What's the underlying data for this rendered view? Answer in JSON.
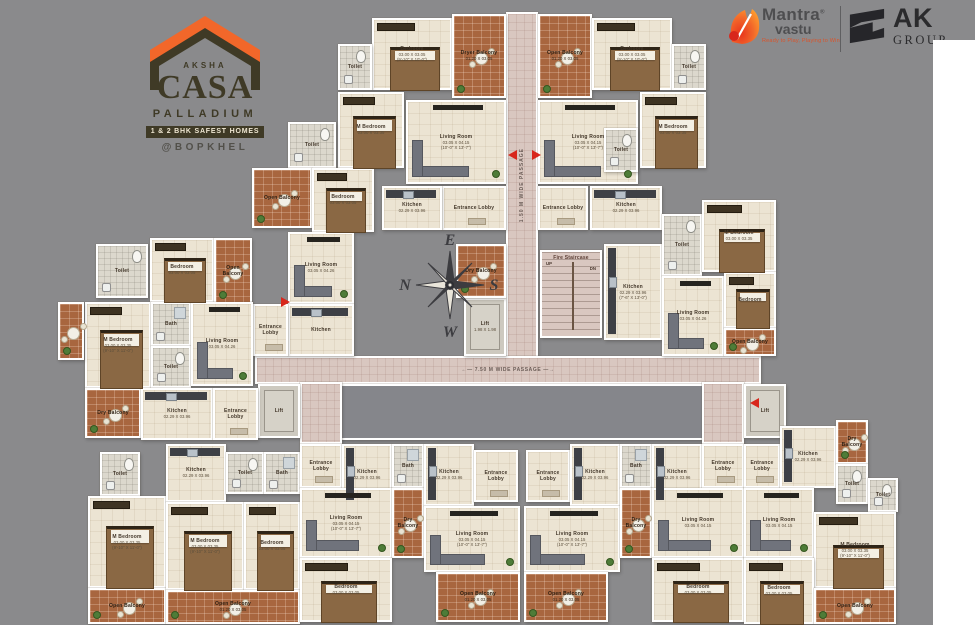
{
  "branding": {
    "aksha": {
      "name": "AKSHA",
      "brand": "CASA",
      "sub": "PALLADIUM",
      "badge": "1 & 2 BHK SAFEST HOMES",
      "location": "@BOPKHEL"
    },
    "mantra": {
      "line1": "Mantra",
      "reg": "®",
      "line2": "vastu",
      "tagline": "Ready to Play, Playing to Win"
    },
    "ak": {
      "line1": "AK",
      "line2": "GROUP"
    }
  },
  "colors": {
    "background": "#8a8a8c",
    "accent_orange": "#f2672a",
    "logo_olive": "#3f3a26",
    "floor_cream": "#ece4d3",
    "balcony_terracotta": "#a8663f",
    "passage_pink": "#d9c7c0",
    "wall_white": "#ffffff",
    "entry_arrow_red": "#d8271c"
  },
  "compass": {
    "top": "E",
    "right": "S",
    "bottom": "W",
    "left": "N"
  },
  "plan": {
    "stair_up": "UP",
    "stair_dn": "DN",
    "rooms": [
      {
        "n": "passage-vertical",
        "t": "passage",
        "x": 506,
        "y": 12,
        "w": 32,
        "h": 346,
        "l": "1.50 M WIDE PASSAGE",
        "rot": 1
      },
      {
        "n": "passage-horizontal",
        "t": "passage",
        "x": 255,
        "y": 356,
        "w": 506,
        "h": 28,
        "l": "←—  7.50 M WIDE PASSAGE  —→"
      },
      {
        "n": "void-center",
        "t": "void",
        "x": 340,
        "y": 384,
        "w": 364,
        "h": 56
      },
      {
        "n": "passage-stub-left",
        "t": "passage",
        "x": 300,
        "y": 382,
        "w": 42,
        "h": 62
      },
      {
        "n": "passage-stub-right",
        "t": "passage",
        "x": 702,
        "y": 382,
        "w": 42,
        "h": 62
      },
      {
        "n": "lift-left",
        "t": "lift",
        "x": 258,
        "y": 384,
        "w": 42,
        "h": 54,
        "l": "Lift"
      },
      {
        "n": "lift-right",
        "t": "lift",
        "x": 744,
        "y": 384,
        "w": 42,
        "h": 54,
        "l": "Lift"
      },
      {
        "n": "lift-central",
        "t": "lift",
        "x": 464,
        "y": 298,
        "w": 42,
        "h": 58,
        "l": "Lift",
        "d1": "1.98 X 1.98"
      },
      {
        "n": "fire-staircase",
        "t": "stair",
        "x": 540,
        "y": 250,
        "w": 62,
        "h": 88,
        "l": "Fire Staircase"
      },
      {
        "n": "bedroom-a",
        "t": "bed",
        "x": 372,
        "y": 18,
        "w": 80,
        "h": 72,
        "l": "Bedroom",
        "d1": "03.00 X 03.05",
        "d2": "(9'-10\" X 10'-0\")"
      },
      {
        "n": "toilet-a",
        "t": "toilet",
        "x": 338,
        "y": 44,
        "w": 34,
        "h": 46,
        "l": "Toilet"
      },
      {
        "n": "dryer-balcony-a",
        "t": "balc",
        "x": 452,
        "y": 14,
        "w": 54,
        "h": 84,
        "l": "Dryer Balcony",
        "d1": "01.20 X 03.05"
      },
      {
        "n": "m-bedroom-a",
        "t": "bed",
        "x": 338,
        "y": 92,
        "w": 66,
        "h": 76,
        "l": "M Bedroom",
        "d1": "03.00 X 03.35"
      },
      {
        "n": "living-a",
        "t": "sofa",
        "x": 406,
        "y": 100,
        "w": 100,
        "h": 84,
        "l": "Living Room",
        "d1": "03.05 X 04.15",
        "d2": "(10'-0\" X 13'-7\")"
      },
      {
        "n": "lobby-a",
        "t": "lobby",
        "x": 442,
        "y": 186,
        "w": 64,
        "h": 44,
        "l": "Entrance Lobby"
      },
      {
        "n": "kitchen-a",
        "t": "kitchen",
        "x": 382,
        "y": 186,
        "w": 60,
        "h": 44,
        "l": "Kitchen",
        "d1": "02.29 X 03.96"
      },
      {
        "n": "dry-balcony-a",
        "t": "balc",
        "x": 456,
        "y": 244,
        "w": 50,
        "h": 54,
        "l": "Dry Balcony"
      },
      {
        "n": "open-balcony-b",
        "t": "balc",
        "x": 538,
        "y": 14,
        "w": 54,
        "h": 84,
        "l": "Open Balcony",
        "d1": "01.20 X 03.05"
      },
      {
        "n": "bedroom-b",
        "t": "bed",
        "x": 592,
        "y": 18,
        "w": 80,
        "h": 72,
        "l": "Bedroom",
        "d1": "03.00 X 03.05",
        "d2": "(9'-10\" X 10'-0\")"
      },
      {
        "n": "toilet-b",
        "t": "toilet",
        "x": 672,
        "y": 44,
        "w": 34,
        "h": 46,
        "l": "Toilet"
      },
      {
        "n": "living-b",
        "t": "sofa",
        "x": 538,
        "y": 100,
        "w": 100,
        "h": 84,
        "l": "Living Room",
        "d1": "03.05 X 04.15",
        "d2": "(10'-0\" X 13'-7\")"
      },
      {
        "n": "m-bedroom-b",
        "t": "bed",
        "x": 640,
        "y": 92,
        "w": 66,
        "h": 76,
        "l": "M Bedroom",
        "d1": "03.00 X 03.35"
      },
      {
        "n": "lobby-b",
        "t": "lobby",
        "x": 538,
        "y": 186,
        "w": 50,
        "h": 44,
        "l": "Entrance Lobby"
      },
      {
        "n": "kitchen-b",
        "t": "kitchen",
        "x": 590,
        "y": 186,
        "w": 72,
        "h": 44,
        "l": "Kitchen",
        "d1": "02.29 X 03.96"
      },
      {
        "n": "toilet-b2",
        "t": "toilet",
        "x": 604,
        "y": 128,
        "w": 34,
        "h": 44,
        "l": "Toilet"
      },
      {
        "n": "toilet-c",
        "t": "toilet",
        "x": 288,
        "y": 122,
        "w": 48,
        "h": 46,
        "l": "Toilet"
      },
      {
        "n": "open-balcony-c",
        "t": "balc",
        "x": 252,
        "y": 168,
        "w": 60,
        "h": 60,
        "l": "Open Balcony"
      },
      {
        "n": "bedroom-c",
        "t": "bed",
        "x": 312,
        "y": 168,
        "w": 62,
        "h": 64,
        "l": "Bedroom",
        "d1": "03.00 X 03.05"
      },
      {
        "n": "living-c",
        "t": "sofa",
        "x": 288,
        "y": 232,
        "w": 66,
        "h": 72,
        "l": "Living Room",
        "d1": "03.05 X 04.26"
      },
      {
        "n": "kitchen-c",
        "t": "kitchen",
        "x": 288,
        "y": 304,
        "w": 66,
        "h": 52,
        "l": "Kitchen"
      },
      {
        "n": "lobby-c",
        "t": "lobby",
        "x": 253,
        "y": 304,
        "w": 35,
        "h": 52,
        "l": "Entrance Lobby"
      },
      {
        "n": "toilet-d",
        "t": "toilet",
        "x": 96,
        "y": 244,
        "w": 52,
        "h": 54,
        "l": "Toilet"
      },
      {
        "n": "bedroom-d",
        "t": "bed",
        "x": 150,
        "y": 238,
        "w": 64,
        "h": 64,
        "l": "Bedroom",
        "d1": "03.00 X 03.05"
      },
      {
        "n": "open-balcony-d",
        "t": "balc",
        "x": 214,
        "y": 238,
        "w": 38,
        "h": 66,
        "l": "Open Balcony"
      },
      {
        "n": "m-bedroom-d",
        "t": "bed",
        "x": 85,
        "y": 302,
        "w": 66,
        "h": 86,
        "l": "M Bedroom",
        "d1": "03.00 X 03.35",
        "d2": "(9'-10\" X 11'-0\")"
      },
      {
        "n": "bath-d",
        "t": "bath",
        "x": 151,
        "y": 302,
        "w": 40,
        "h": 44,
        "l": "Bath"
      },
      {
        "n": "toilet-d2",
        "t": "toilet",
        "x": 151,
        "y": 346,
        "w": 40,
        "h": 42,
        "l": "Toilet"
      },
      {
        "n": "living-d",
        "t": "sofa",
        "x": 191,
        "y": 302,
        "w": 62,
        "h": 84,
        "l": "Living Room",
        "d1": "03.05 X 04.26"
      },
      {
        "n": "open-balcony-west",
        "t": "balc",
        "x": 58,
        "y": 302,
        "w": 26,
        "h": 58
      },
      {
        "n": "dry-balcony-d",
        "t": "balc",
        "x": 85,
        "y": 388,
        "w": 56,
        "h": 50,
        "l": "Dry Balcony"
      },
      {
        "n": "kitchen-d",
        "t": "kitchen",
        "x": 141,
        "y": 388,
        "w": 72,
        "h": 52,
        "l": "Kitchen",
        "d1": "02.29 X 03.96"
      },
      {
        "n": "lobby-d",
        "t": "lobby",
        "x": 213,
        "y": 388,
        "w": 45,
        "h": 52,
        "l": "Entrance Lobby"
      },
      {
        "n": "kitchen-r",
        "t": "kitchen",
        "x": 604,
        "y": 244,
        "w": 58,
        "h": 96,
        "l": "Kitchen",
        "d1": "02.29 X 03.96",
        "d2": "(7'-6\" X 13'-0\")"
      },
      {
        "n": "toilet-r",
        "t": "toilet",
        "x": 662,
        "y": 214,
        "w": 40,
        "h": 62,
        "l": "Toilet"
      },
      {
        "n": "m-bedroom-r",
        "t": "bed",
        "x": 702,
        "y": 200,
        "w": 74,
        "h": 72,
        "l": "M Bedroom",
        "d1": "03.00 X 03.35"
      },
      {
        "n": "living-r",
        "t": "sofa",
        "x": 662,
        "y": 276,
        "w": 62,
        "h": 80,
        "l": "Living Room",
        "d1": "03.05 X 04.26"
      },
      {
        "n": "bedroom-r",
        "t": "bed",
        "x": 724,
        "y": 272,
        "w": 52,
        "h": 56,
        "l": "Bedroom"
      },
      {
        "n": "open-balcony-r",
        "t": "balc",
        "x": 724,
        "y": 328,
        "w": 52,
        "h": 28,
        "l": "Open Balcony"
      },
      {
        "n": "toilet-w1",
        "t": "toilet",
        "x": 100,
        "y": 452,
        "w": 40,
        "h": 44,
        "l": "Toilet"
      },
      {
        "n": "m-bedroom-w1",
        "t": "bed",
        "x": 88,
        "y": 496,
        "w": 78,
        "h": 92,
        "l": "M Bedroom",
        "d1": "03.00 X 03.35",
        "d2": "(9'-10\" X 11'-0\")"
      },
      {
        "n": "open-balcony-w1",
        "t": "balc",
        "x": 88,
        "y": 588,
        "w": 78,
        "h": 36,
        "l": "Open Balcony"
      },
      {
        "n": "kitchen-u5",
        "t": "kitchen",
        "x": 166,
        "y": 444,
        "w": 60,
        "h": 58,
        "l": "Kitchen",
        "d1": "02.29 X 03.96"
      },
      {
        "n": "toilet-u5",
        "t": "toilet",
        "x": 226,
        "y": 452,
        "w": 38,
        "h": 42,
        "l": "Toilet"
      },
      {
        "n": "bath-u5",
        "t": "bath",
        "x": 264,
        "y": 452,
        "w": 36,
        "h": 42,
        "l": "Bath"
      },
      {
        "n": "m-bedroom-u5",
        "t": "bed",
        "x": 166,
        "y": 502,
        "w": 78,
        "h": 88,
        "l": "M Bedroom",
        "d1": "03.00 X 03.35",
        "d2": "(9'-10\" X 11'-0\")"
      },
      {
        "n": "bedroom-u5",
        "t": "bed",
        "x": 244,
        "y": 502,
        "w": 56,
        "h": 88,
        "l": "Bedroom",
        "d1": "03.00 X 03.05"
      },
      {
        "n": "open-balcony-u5",
        "t": "balc",
        "x": 166,
        "y": 590,
        "w": 134,
        "h": 34,
        "l": "Open Balcony",
        "d1": "01.20 X 03.05"
      },
      {
        "n": "lobby-u6",
        "t": "lobby",
        "x": 300,
        "y": 444,
        "w": 42,
        "h": 44,
        "l": "Entrance Lobby"
      },
      {
        "n": "kitchen-u6",
        "t": "kitchen",
        "x": 342,
        "y": 444,
        "w": 50,
        "h": 62,
        "l": "Kitchen",
        "d1": "02.29 X 03.96"
      },
      {
        "n": "bath-u6",
        "t": "bath",
        "x": 392,
        "y": 444,
        "w": 32,
        "h": 44,
        "l": "Bath"
      },
      {
        "n": "living-u6",
        "t": "sofa",
        "x": 300,
        "y": 488,
        "w": 92,
        "h": 70,
        "l": "Living Room",
        "d1": "03.05 X 04.15",
        "d2": "(10'-0\" X 13'-7\")"
      },
      {
        "n": "dry-balcony-u6",
        "t": "balc",
        "x": 392,
        "y": 488,
        "w": 32,
        "h": 70,
        "l": "Dry Balcony"
      },
      {
        "n": "bedroom-u6",
        "t": "bed",
        "x": 300,
        "y": 558,
        "w": 92,
        "h": 64,
        "l": "Bedroom",
        "d1": "03.00 X 03.05"
      },
      {
        "n": "kitchen-f",
        "t": "kitchen",
        "x": 424,
        "y": 444,
        "w": 50,
        "h": 62,
        "l": "Kitchen",
        "d1": "02.29 X 03.96"
      },
      {
        "n": "lobby-f",
        "t": "lobby",
        "x": 474,
        "y": 450,
        "w": 44,
        "h": 52,
        "l": "Entrance Lobby"
      },
      {
        "n": "living-f",
        "t": "sofa",
        "x": 424,
        "y": 506,
        "w": 96,
        "h": 66,
        "l": "Living Room",
        "d1": "03.05 X 04.15",
        "d2": "(10'-0\" X 13'-7\")"
      },
      {
        "n": "open-balcony-f",
        "t": "balc",
        "x": 436,
        "y": 572,
        "w": 84,
        "h": 50,
        "l": "Open Balcony",
        "d1": "01.20 X 03.05"
      },
      {
        "n": "lobby-g",
        "t": "lobby",
        "x": 526,
        "y": 450,
        "w": 44,
        "h": 52,
        "l": "Entrance Lobby"
      },
      {
        "n": "kitchen-g",
        "t": "kitchen",
        "x": 570,
        "y": 444,
        "w": 50,
        "h": 62,
        "l": "Kitchen",
        "d1": "02.29 X 03.96"
      },
      {
        "n": "living-g",
        "t": "sofa",
        "x": 524,
        "y": 506,
        "w": 96,
        "h": 66,
        "l": "Living Room",
        "d1": "03.05 X 04.15",
        "d2": "(10'-0\" X 13'-7\")"
      },
      {
        "n": "open-balcony-g",
        "t": "balc",
        "x": 524,
        "y": 572,
        "w": 84,
        "h": 50,
        "l": "Open Balcony",
        "d1": "01.20 X 03.05"
      },
      {
        "n": "bath-u6r",
        "t": "bath",
        "x": 620,
        "y": 444,
        "w": 32,
        "h": 44,
        "l": "Bath"
      },
      {
        "n": "kitchen-u6r",
        "t": "kitchen",
        "x": 652,
        "y": 444,
        "w": 50,
        "h": 62,
        "l": "Kitchen",
        "d1": "02.29 X 03.96"
      },
      {
        "n": "lobby-u6r",
        "t": "lobby",
        "x": 702,
        "y": 444,
        "w": 42,
        "h": 44,
        "l": "Entrance Lobby"
      },
      {
        "n": "dry-balcony-u6r",
        "t": "balc",
        "x": 620,
        "y": 488,
        "w": 32,
        "h": 70,
        "l": "Dry Balcony"
      },
      {
        "n": "living-u6r",
        "t": "sofa",
        "x": 652,
        "y": 488,
        "w": 92,
        "h": 70,
        "l": "Living Room",
        "d1": "03.05 X 04.15"
      },
      {
        "n": "bedroom-u6r",
        "t": "bed",
        "x": 652,
        "y": 558,
        "w": 92,
        "h": 64,
        "l": "Bedroom",
        "d1": "03.00 X 03.05"
      },
      {
        "n": "lobby-br",
        "t": "lobby",
        "x": 744,
        "y": 444,
        "w": 36,
        "h": 44,
        "l": "Entrance Lobby"
      },
      {
        "n": "kitchen-br",
        "t": "kitchen",
        "x": 780,
        "y": 426,
        "w": 56,
        "h": 62,
        "l": "Kitchen",
        "d1": "02.29 X 03.96"
      },
      {
        "n": "dry-balcony-br",
        "t": "balc",
        "x": 836,
        "y": 420,
        "w": 32,
        "h": 44,
        "l": "Dry Balcony"
      },
      {
        "n": "toilet-br",
        "t": "toilet",
        "x": 836,
        "y": 464,
        "w": 32,
        "h": 40,
        "l": "Toilet"
      },
      {
        "n": "toilet-br2",
        "t": "toilet",
        "x": 868,
        "y": 478,
        "w": 30,
        "h": 34,
        "l": "Toilet"
      },
      {
        "n": "living-br",
        "t": "sofa",
        "x": 744,
        "y": 488,
        "w": 70,
        "h": 70,
        "l": "Living Room",
        "d1": "03.05 X 04.15"
      },
      {
        "n": "m-bedroom-br",
        "t": "bed",
        "x": 814,
        "y": 512,
        "w": 82,
        "h": 76,
        "l": "M Bedroom",
        "d1": "03.00 X 03.35",
        "d2": "(9'-10\" X 11'-0\")"
      },
      {
        "n": "bedroom-br",
        "t": "bed",
        "x": 744,
        "y": 558,
        "w": 70,
        "h": 66,
        "l": "Bedroom",
        "d1": "03.00 X 03.05"
      },
      {
        "n": "open-balcony-br",
        "t": "balc",
        "x": 814,
        "y": 588,
        "w": 82,
        "h": 36,
        "l": "Open Balcony"
      }
    ],
    "arrows": [
      {
        "x": 508,
        "y": 150,
        "dir": "left"
      },
      {
        "x": 532,
        "y": 150,
        "dir": "right"
      },
      {
        "x": 281,
        "y": 297,
        "dir": "right"
      },
      {
        "x": 750,
        "y": 398,
        "dir": "left"
      }
    ]
  }
}
